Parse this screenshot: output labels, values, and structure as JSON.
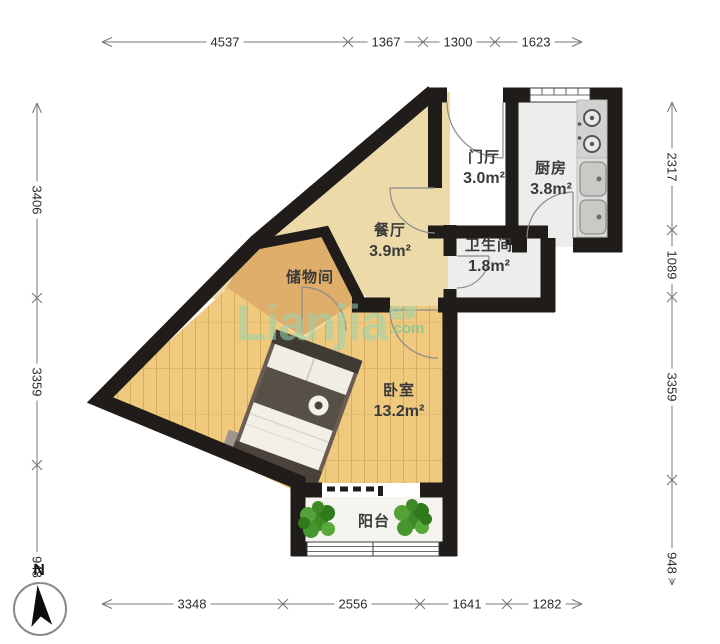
{
  "dimensions": {
    "top": [
      {
        "value": "4537"
      },
      {
        "value": "1367"
      },
      {
        "value": "1300"
      },
      {
        "value": "1623"
      }
    ],
    "bottom": [
      {
        "value": "3348"
      },
      {
        "value": "2556"
      },
      {
        "value": "1641"
      },
      {
        "value": "1282"
      }
    ],
    "left": [
      {
        "value": "3406"
      },
      {
        "value": "3359"
      },
      {
        "value": "948"
      }
    ],
    "right": [
      {
        "value": "2317"
      },
      {
        "value": "1089"
      },
      {
        "value": "3359"
      },
      {
        "value": "948"
      }
    ],
    "unit": "mm"
  },
  "rooms": {
    "entry": {
      "name": "门厅",
      "area": "3.0m²"
    },
    "kitchen": {
      "name": "厨房",
      "area": "3.8m²"
    },
    "dining": {
      "name": "餐厅",
      "area": "3.9m²"
    },
    "bathroom": {
      "name": "卫生间",
      "area": "1.8m²"
    },
    "storage": {
      "name": "储物间"
    },
    "bedroom": {
      "name": "卧室",
      "area": "13.2m²"
    },
    "balcony": {
      "name": "阳台"
    }
  },
  "watermark": {
    "brand": "Lianjia",
    "company": "链家",
    "domain": ".com"
  },
  "compass": {
    "label": "N"
  },
  "icons": [
    "north-arrow-icon",
    "plant-icon",
    "stove-icon",
    "sink-icon",
    "bed",
    "door-arc",
    "window"
  ],
  "colors": {
    "wall": "#1f1c19",
    "floor_beige": "#eddaa9",
    "floor_storage": "#dfae6b",
    "floor_tile": "#ededeb",
    "floor_wood": "#eec97e",
    "floor_wood_line": "#d9ab5c",
    "floor_balcony": "#f6f4ef",
    "plant_green": "#3e8a26",
    "bed_frame": "#6a5c50",
    "watermark_green": "#9bd6b1",
    "dimension_line": "#777777"
  }
}
